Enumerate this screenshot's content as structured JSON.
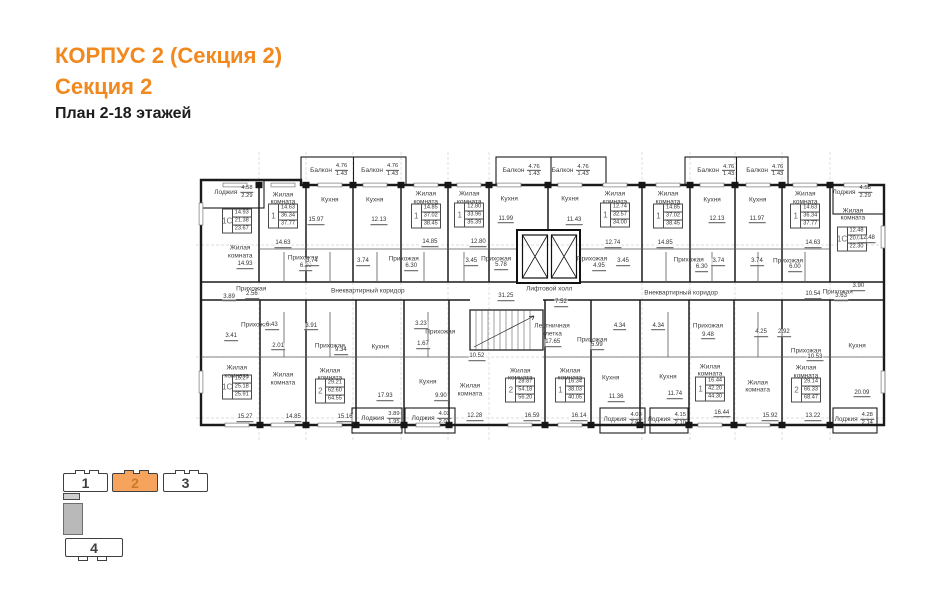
{
  "page": {
    "title": "КОРПУС 2 (Секция 2)",
    "section": "Секция 2",
    "subtitle": "План 2-18 этажей",
    "accent_color": "#F1891E"
  },
  "minimap": {
    "sections": [
      {
        "label": "1",
        "active": false
      },
      {
        "label": "2",
        "active": true
      },
      {
        "label": "3",
        "active": false
      },
      {
        "label": "4",
        "active": false
      }
    ]
  },
  "plan": {
    "labels": [
      {
        "k": "bal",
        "t": "Балкон",
        "a": "4.76",
        "b": "1.43",
        "x": 19.3,
        "y": 6.2
      },
      {
        "k": "bal",
        "t": "Балкон",
        "a": "4.76",
        "b": "1.43",
        "x": 26.7,
        "y": 6.2
      },
      {
        "k": "bal",
        "t": "Балкон",
        "a": "4.76",
        "b": "1.43",
        "x": 47.2,
        "y": 6.4
      },
      {
        "k": "bal",
        "t": "Балкон",
        "a": "4.76",
        "b": "1.43",
        "x": 54.3,
        "y": 6.4
      },
      {
        "k": "bal",
        "t": "Балкон",
        "a": "4.76",
        "b": "1.43",
        "x": 75.4,
        "y": 6.4
      },
      {
        "k": "bal",
        "t": "Балкон",
        "a": "4.76",
        "b": "1.43",
        "x": 82.5,
        "y": 6.4
      },
      {
        "k": "bal",
        "t": "Лоджия",
        "a": "4.58",
        "b": "2.29",
        "x": 5.5,
        "y": 13.8
      },
      {
        "k": "bal",
        "t": "Лоджия",
        "a": "4.58",
        "b": "2.29",
        "x": 95.1,
        "y": 13.8
      },
      {
        "k": "bal",
        "t": "Лоджия",
        "a": "3.89",
        "b": "1.95",
        "x": 26.8,
        "y": 91.7
      },
      {
        "k": "bal",
        "t": "Лоджия",
        "a": "4.03",
        "b": "2.02",
        "x": 34.1,
        "y": 91.7
      },
      {
        "k": "bal",
        "t": "Лоджия",
        "a": "4.03",
        "b": "2.02",
        "x": 61.9,
        "y": 92.1
      },
      {
        "k": "bal",
        "t": "Лоджия",
        "a": "4.15",
        "b": "2.10",
        "x": 68.3,
        "y": 92.1
      },
      {
        "k": "bal",
        "t": "Лоджия",
        "a": "4.28",
        "b": "2.14",
        "x": 95.4,
        "y": 92.1
      },
      {
        "k": "card",
        "ty": "1С",
        "v": [
          "14.93",
          "21.38",
          "23.67"
        ],
        "x": 5.9,
        "y": 23.8
      },
      {
        "k": "card",
        "ty": "1",
        "v": [
          "14.63",
          "36.34",
          "37.77"
        ],
        "x": 12.6,
        "y": 22.1
      },
      {
        "k": "card",
        "ty": "1",
        "v": [
          "14.85",
          "37.02",
          "38.45"
        ],
        "x": 33.3,
        "y": 22.1
      },
      {
        "k": "card",
        "ty": "1",
        "v": [
          "12.80",
          "33.96",
          "35.39"
        ],
        "x": 39.6,
        "y": 21.7
      },
      {
        "k": "card",
        "ty": "1",
        "v": [
          "12.74",
          "32.57",
          "34.00"
        ],
        "x": 60.7,
        "y": 21.7
      },
      {
        "k": "card",
        "ty": "1",
        "v": [
          "14.85",
          "37.02",
          "38.45"
        ],
        "x": 68.4,
        "y": 22.1
      },
      {
        "k": "card",
        "ty": "1",
        "v": [
          "14.63",
          "36.34",
          "37.77"
        ],
        "x": 88.3,
        "y": 22.1
      },
      {
        "k": "card",
        "ty": "1С",
        "v": [
          "12.48",
          "20.01",
          "22.30"
        ],
        "x": 95.0,
        "y": 30.0
      },
      {
        "k": "card",
        "ty": "1С",
        "v": [
          "15.27",
          "25.18",
          "25.91"
        ],
        "x": 5.9,
        "y": 81.0
      },
      {
        "k": "card",
        "ty": "2",
        "v": [
          "29.21",
          "62.60",
          "64.55"
        ],
        "x": 19.4,
        "y": 82.4
      },
      {
        "k": "card",
        "ty": "2",
        "v": [
          "28.87",
          "54.18",
          "56.20"
        ],
        "x": 47.0,
        "y": 82.1
      },
      {
        "k": "card",
        "ty": "1",
        "v": [
          "16.34",
          "38.03",
          "40.05"
        ],
        "x": 54.2,
        "y": 82.1
      },
      {
        "k": "card",
        "ty": "1",
        "v": [
          "16.44",
          "42.20",
          "44.30"
        ],
        "x": 74.5,
        "y": 81.7
      },
      {
        "k": "card",
        "ty": "2",
        "v": [
          "29.14",
          "66.33",
          "68.47"
        ],
        "x": 88.4,
        "y": 82.1
      },
      {
        "k": "room",
        "t": "Жилая\nкомната",
        "x": 6.4,
        "y": 34.5
      },
      {
        "k": "room",
        "t": "Жилая\nкомната",
        "x": 12.6,
        "y": 16.2
      },
      {
        "k": "room",
        "t": "Кухня",
        "x": 19.4,
        "y": 16.6
      },
      {
        "k": "room",
        "t": "Кухня",
        "x": 25.9,
        "y": 16.6
      },
      {
        "k": "room",
        "t": "Жилая\nкомната",
        "x": 33.3,
        "y": 15.9
      },
      {
        "k": "room",
        "t": "Жилая\nкомната",
        "x": 39.6,
        "y": 15.9
      },
      {
        "k": "room",
        "t": "Кухня",
        "x": 45.4,
        "y": 16.2
      },
      {
        "k": "room",
        "t": "Кухня",
        "x": 54.2,
        "y": 16.2
      },
      {
        "k": "room",
        "t": "Жилая\nкомната",
        "x": 60.7,
        "y": 15.9
      },
      {
        "k": "room",
        "t": "Жилая\nкомната",
        "x": 68.4,
        "y": 15.9
      },
      {
        "k": "room",
        "t": "Кухня",
        "x": 74.8,
        "y": 16.6
      },
      {
        "k": "room",
        "t": "Кухня",
        "x": 81.4,
        "y": 16.6
      },
      {
        "k": "room",
        "t": "Жилая\nкомната",
        "x": 88.3,
        "y": 15.9
      },
      {
        "k": "room",
        "t": "Жилая\nкомната",
        "x": 95.2,
        "y": 21.7
      },
      {
        "k": "room",
        "t": "Прихожая",
        "x": 15.5,
        "y": 36.6
      },
      {
        "k": "room",
        "t": "Прихожая",
        "x": 30.1,
        "y": 36.9
      },
      {
        "k": "room",
        "t": "Прихожая",
        "x": 43.5,
        "y": 36.9
      },
      {
        "k": "room",
        "t": "Прихожая",
        "x": 57.4,
        "y": 36.9
      },
      {
        "k": "room",
        "t": "Прихожая",
        "x": 71.4,
        "y": 37.2
      },
      {
        "k": "room",
        "t": "Прихожая",
        "x": 85.8,
        "y": 37.6
      },
      {
        "k": "room",
        "t": "Прихожая",
        "x": 8.0,
        "y": 47.2
      },
      {
        "k": "room",
        "t": "Прихожая",
        "x": 93.0,
        "y": 48.3
      },
      {
        "k": "room",
        "t": "Внеквартирный коридор",
        "x": 24.9,
        "y": 47.9
      },
      {
        "k": "room",
        "t": "Внеквартирный коридор",
        "x": 70.3,
        "y": 48.6
      },
      {
        "k": "room",
        "t": "Лифтовой холл",
        "x": 51.2,
        "y": 47.2
      },
      {
        "k": "room",
        "t": "Лестничная\nклетка",
        "x": 51.6,
        "y": 61.4
      },
      {
        "k": "room",
        "t": "Прихожая",
        "x": 19.4,
        "y": 66.9
      },
      {
        "k": "room",
        "t": "Прихожая",
        "x": 35.4,
        "y": 62.1
      },
      {
        "k": "room",
        "t": "Прихожая",
        "x": 57.4,
        "y": 64.8
      },
      {
        "k": "room",
        "t": "Прихожая",
        "x": 74.2,
        "y": 60.0
      },
      {
        "k": "room",
        "t": "Прихожая",
        "x": 88.4,
        "y": 68.6
      },
      {
        "k": "room",
        "t": "Прихожая",
        "x": 8.7,
        "y": 59.7
      },
      {
        "k": "room",
        "t": "Жилая\nкомната",
        "x": 5.9,
        "y": 75.9
      },
      {
        "k": "room",
        "t": "Жилая\nкомната",
        "x": 12.6,
        "y": 78.3
      },
      {
        "k": "room",
        "t": "Жилая\nкомната",
        "x": 19.4,
        "y": 76.9
      },
      {
        "k": "room",
        "t": "Кухня",
        "x": 26.7,
        "y": 67.2
      },
      {
        "k": "room",
        "t": "Кухня",
        "x": 33.6,
        "y": 79.3
      },
      {
        "k": "room",
        "t": "Жилая\nкомната",
        "x": 39.7,
        "y": 82.1
      },
      {
        "k": "room",
        "t": "Жилая\nкомната",
        "x": 47.0,
        "y": 76.9
      },
      {
        "k": "room",
        "t": "Жилая\nкомната",
        "x": 54.2,
        "y": 76.9
      },
      {
        "k": "room",
        "t": "Кухня",
        "x": 60.1,
        "y": 77.9
      },
      {
        "k": "room",
        "t": "Кухня",
        "x": 68.4,
        "y": 77.6
      },
      {
        "k": "room",
        "t": "Жилая\nкомната",
        "x": 74.5,
        "y": 75.5
      },
      {
        "k": "room",
        "t": "Жилая\nкомната",
        "x": 81.4,
        "y": 81.0
      },
      {
        "k": "room",
        "t": "Жилая\nкомната",
        "x": 88.4,
        "y": 75.9
      },
      {
        "k": "room",
        "t": "Кухня",
        "x": 95.8,
        "y": 66.9
      },
      {
        "k": "dim",
        "t": "14.93",
        "x": 7.1,
        "y": 39.0
      },
      {
        "k": "dim",
        "t": "14.63",
        "x": 12.6,
        "y": 31.7
      },
      {
        "k": "dim",
        "t": "15.97",
        "x": 17.4,
        "y": 23.8
      },
      {
        "k": "dim",
        "t": "12.13",
        "x": 26.5,
        "y": 23.8
      },
      {
        "k": "dim",
        "t": "14.85",
        "x": 33.9,
        "y": 31.4
      },
      {
        "k": "dim",
        "t": "12.80",
        "x": 40.9,
        "y": 31.4
      },
      {
        "k": "dim",
        "t": "11.99",
        "x": 44.9,
        "y": 23.4
      },
      {
        "k": "dim",
        "t": "11.43",
        "x": 54.8,
        "y": 23.8
      },
      {
        "k": "dim",
        "t": "12.74",
        "x": 60.4,
        "y": 31.7
      },
      {
        "k": "dim",
        "t": "14.85",
        "x": 68.0,
        "y": 31.7
      },
      {
        "k": "dim",
        "t": "12.13",
        "x": 75.5,
        "y": 23.4
      },
      {
        "k": "dim",
        "t": "11.97",
        "x": 81.3,
        "y": 23.4
      },
      {
        "k": "dim",
        "t": "14.63",
        "x": 89.4,
        "y": 31.7
      },
      {
        "k": "dim",
        "t": "12.48",
        "x": 97.3,
        "y": 30.0
      },
      {
        "k": "dim",
        "t": "6.30",
        "x": 15.9,
        "y": 39.7
      },
      {
        "k": "dim",
        "t": "3.74",
        "x": 16.8,
        "y": 37.9
      },
      {
        "k": "dim",
        "t": "3.74",
        "x": 24.2,
        "y": 37.9
      },
      {
        "k": "dim",
        "t": "6.30",
        "x": 31.2,
        "y": 39.7
      },
      {
        "k": "dim",
        "t": "3.45",
        "x": 39.9,
        "y": 37.9
      },
      {
        "k": "dim",
        "t": "5.78",
        "x": 44.2,
        "y": 39.3
      },
      {
        "k": "dim",
        "t": "4.95",
        "x": 58.4,
        "y": 39.7
      },
      {
        "k": "dim",
        "t": "3.45",
        "x": 61.9,
        "y": 37.9
      },
      {
        "k": "dim",
        "t": "6.30",
        "x": 73.3,
        "y": 40.0
      },
      {
        "k": "dim",
        "t": "3.74",
        "x": 75.7,
        "y": 37.9
      },
      {
        "k": "dim",
        "t": "3.74",
        "x": 81.3,
        "y": 37.9
      },
      {
        "k": "dim",
        "t": "6.00",
        "x": 86.8,
        "y": 40.0
      },
      {
        "k": "dim",
        "t": "2.56",
        "x": 8.1,
        "y": 49.3
      },
      {
        "k": "dim",
        "t": "3.89",
        "x": 4.8,
        "y": 50.3
      },
      {
        "k": "dim",
        "t": "3.63",
        "x": 93.5,
        "y": 50.0
      },
      {
        "k": "dim",
        "t": "3.90",
        "x": 96.0,
        "y": 46.6
      },
      {
        "k": "dim",
        "t": "10.54",
        "x": 89.4,
        "y": 49.3
      },
      {
        "k": "dim",
        "t": "31.25",
        "x": 44.9,
        "y": 50.0
      },
      {
        "k": "dim",
        "t": "7.52",
        "x": 52.9,
        "y": 52.1
      },
      {
        "k": "dim",
        "t": "17.65",
        "x": 51.7,
        "y": 65.9
      },
      {
        "k": "dim",
        "t": "10.52",
        "x": 40.7,
        "y": 70.7
      },
      {
        "k": "dim",
        "t": "4.34",
        "x": 61.4,
        "y": 60.3
      },
      {
        "k": "dim",
        "t": "4.34",
        "x": 67.0,
        "y": 60.3
      },
      {
        "k": "dim",
        "t": "3.23",
        "x": 32.6,
        "y": 59.7
      },
      {
        "k": "dim",
        "t": "1.67",
        "x": 32.9,
        "y": 66.6
      },
      {
        "k": "dim",
        "t": "3.41",
        "x": 5.1,
        "y": 63.8
      },
      {
        "k": "dim",
        "t": "2.01",
        "x": 11.9,
        "y": 67.2
      },
      {
        "k": "dim",
        "t": "3.91",
        "x": 16.7,
        "y": 60.3
      },
      {
        "k": "dim",
        "t": "6.43",
        "x": 11.0,
        "y": 60.0
      },
      {
        "k": "dim",
        "t": "9.34",
        "x": 21.0,
        "y": 68.6
      },
      {
        "k": "dim",
        "t": "5.99",
        "x": 58.1,
        "y": 66.9
      },
      {
        "k": "dim",
        "t": "9.48",
        "x": 74.2,
        "y": 63.4
      },
      {
        "k": "dim",
        "t": "10.53",
        "x": 89.7,
        "y": 71.0
      },
      {
        "k": "dim",
        "t": "4.25",
        "x": 81.9,
        "y": 62.4
      },
      {
        "k": "dim",
        "t": "2.92",
        "x": 85.2,
        "y": 62.4
      },
      {
        "k": "dim",
        "t": "17.93",
        "x": 27.4,
        "y": 84.5
      },
      {
        "k": "dim",
        "t": "9.90",
        "x": 35.5,
        "y": 84.5
      },
      {
        "k": "dim",
        "t": "12.28",
        "x": 40.4,
        "y": 91.4
      },
      {
        "k": "dim",
        "t": "15.27",
        "x": 7.1,
        "y": 91.7
      },
      {
        "k": "dim",
        "t": "14.85",
        "x": 14.1,
        "y": 91.7
      },
      {
        "k": "dim",
        "t": "15.16",
        "x": 21.6,
        "y": 91.7
      },
      {
        "k": "dim",
        "t": "16.59",
        "x": 48.7,
        "y": 91.4
      },
      {
        "k": "dim",
        "t": "16.14",
        "x": 55.5,
        "y": 91.4
      },
      {
        "k": "dim",
        "t": "11.36",
        "x": 60.9,
        "y": 84.8
      },
      {
        "k": "dim",
        "t": "11.74",
        "x": 69.4,
        "y": 83.8
      },
      {
        "k": "dim",
        "t": "16.44",
        "x": 76.2,
        "y": 90.3
      },
      {
        "k": "dim",
        "t": "15.92",
        "x": 83.2,
        "y": 91.4
      },
      {
        "k": "dim",
        "t": "13.22",
        "x": 89.4,
        "y": 91.4
      },
      {
        "k": "dim",
        "t": "20.09",
        "x": 96.5,
        "y": 83.4
      }
    ]
  }
}
